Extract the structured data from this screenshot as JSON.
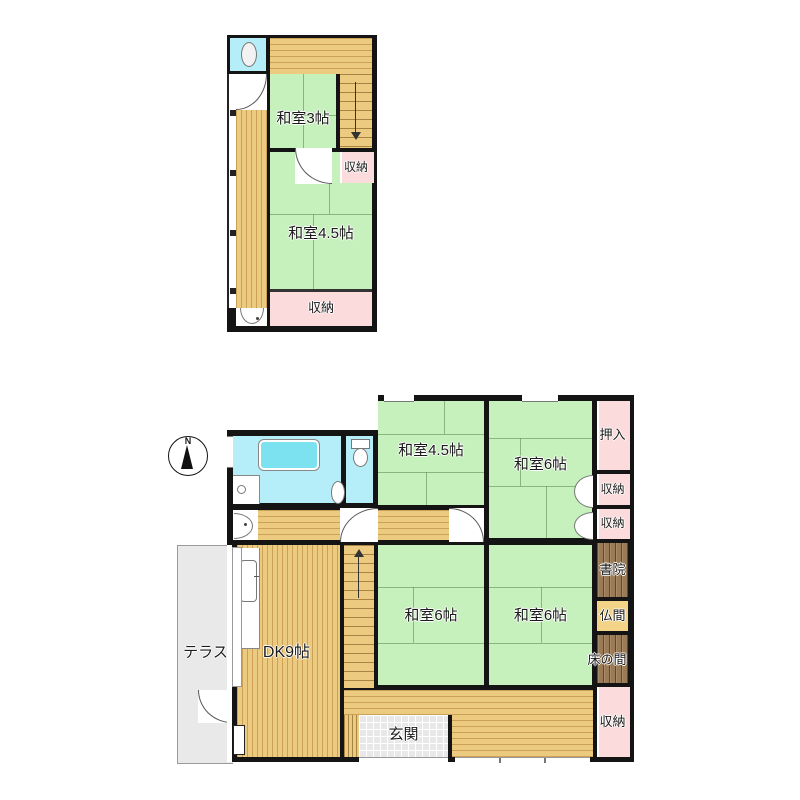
{
  "title": "間取り図",
  "compass": {
    "label": "N"
  },
  "floor2": {
    "rooms": {
      "washitsu3": "和室3帖",
      "shuno_right": "収納",
      "washitsu45": "和室4.5帖",
      "shuno_bottom": "収納"
    }
  },
  "floor1": {
    "rooms": {
      "washitsu45": "和室4.5帖",
      "washitsu6_tr": "和室6帖",
      "oshiire": "押入",
      "shuno1": "収納",
      "shuno2": "収納",
      "shoin": "書院",
      "butsuma": "仏間",
      "tokonoma": "床の間",
      "shuno3": "収納",
      "washitsu6_bl": "和室6帖",
      "washitsu6_br": "和室6帖",
      "dk": "DK9帖",
      "terrace": "テラス",
      "genkan": "玄関"
    }
  },
  "colors": {
    "wall": "#141414",
    "tatami_green": "#c6f1bc",
    "wood_floor": "#ecca7f",
    "closet_pink": "#fbdbdb",
    "bath_cyan": "#b5eef8",
    "bathtub_cyan": "#7de2f0",
    "alcove_brown": "#9b7b56",
    "butsuma_tan": "#f2d387",
    "terrace_gray": "#e9e9e9",
    "tile_gray": "#e8e8e8"
  }
}
